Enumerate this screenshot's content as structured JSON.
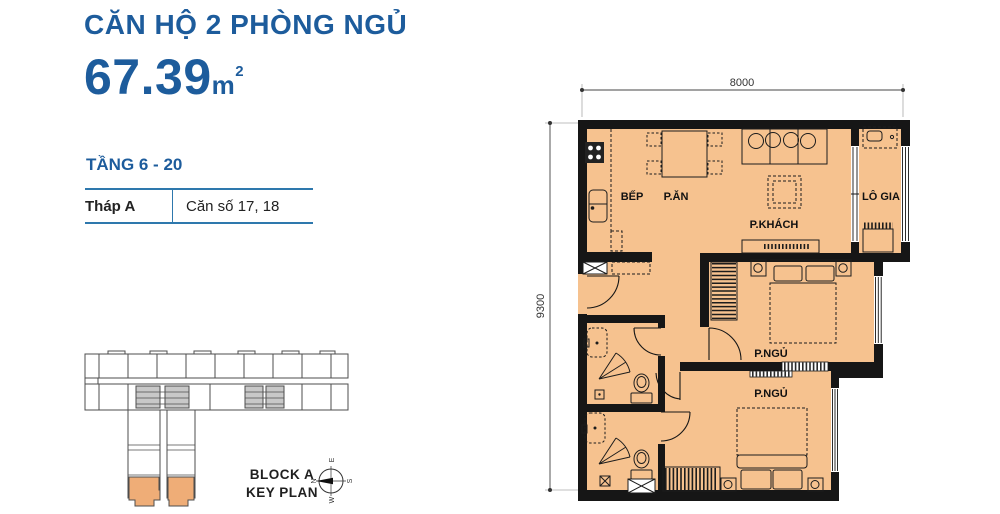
{
  "header": {
    "title": "CĂN HỘ 2 PHÒNG NGỦ",
    "area_value": "67.39",
    "area_unit": "m",
    "area_unit_sup": "2",
    "floors_label": "TẦNG 6 - 20"
  },
  "info_table": {
    "tower": "Tháp A",
    "units": "Căn số 17, 18"
  },
  "key_plan": {
    "caption_line1": "BLOCK A",
    "caption_line2": "KEY PLAN",
    "compass": {
      "n": "N",
      "e": "E",
      "s": "S",
      "w": "W"
    },
    "highlight_color": "#efad77"
  },
  "floor_plan": {
    "dim_width": "8000",
    "dim_height": "9300",
    "rooms": [
      {
        "id": "kitchen",
        "label": "BẾP"
      },
      {
        "id": "dining",
        "label": "P.ĂN"
      },
      {
        "id": "living",
        "label": "P.KHÁCH"
      },
      {
        "id": "loggia",
        "label": "LÔ GIA"
      },
      {
        "id": "bedroom-1",
        "label": "P.NGỦ"
      },
      {
        "id": "bedroom-2",
        "label": "P.NGỦ"
      }
    ],
    "floor_color": "#f6c28f",
    "wall_color": "#161616"
  },
  "colors": {
    "accent_blue": "#1d5c9c",
    "table_line_blue": "#2e78ad",
    "text_dark": "#222222"
  }
}
